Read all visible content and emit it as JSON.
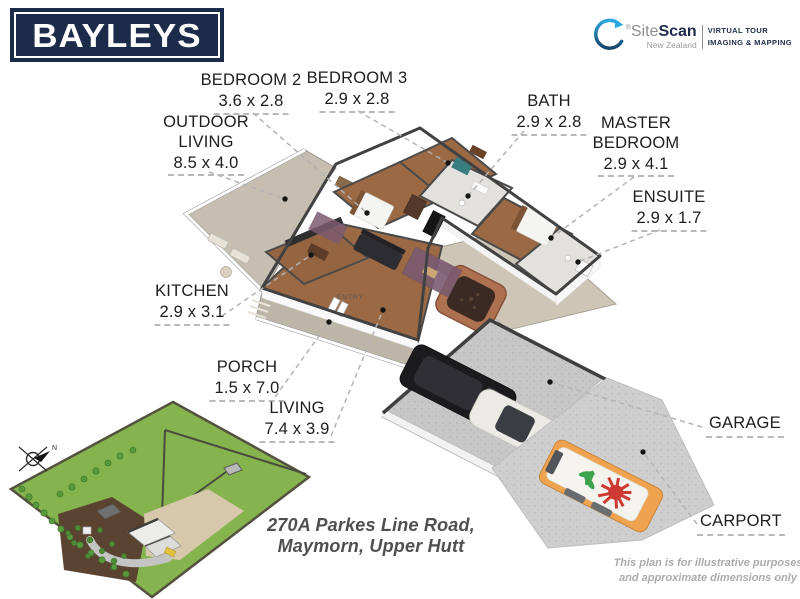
{
  "brand": {
    "logo_text": "BAYLEYS",
    "sitescan": {
      "registered_mark": "®",
      "site": "Site",
      "scan": "Scan",
      "region": "New Zealand",
      "tag_line1": "VIRTUAL TOUR",
      "tag_line2": "IMAGING & MAPPING"
    }
  },
  "address": {
    "line1": "270A Parkes Line Road,",
    "line2": "Maymorn, Upper Hutt"
  },
  "disclaimer": {
    "line1": "This plan is for illustrative purposes",
    "line2": "and approximate dimensions only"
  },
  "plan": {
    "entry_label": "ENTRY",
    "compass_label": "N"
  },
  "rooms": [
    {
      "id": "bedroom2",
      "name": "BEDROOM 2",
      "dims": "3.6 x 2.8"
    },
    {
      "id": "bedroom3",
      "name": "BEDROOM 3",
      "dims": "2.9 x 2.8"
    },
    {
      "id": "outdoor-living",
      "name": "OUTDOOR LIVING",
      "dims": "8.5 x 4.0"
    },
    {
      "id": "bath",
      "name": "BATH",
      "dims": "2.9 x 2.8"
    },
    {
      "id": "master-bedroom",
      "name": "MASTER BEDROOM",
      "dims": "2.9 x 4.1"
    },
    {
      "id": "ensuite",
      "name": "ENSUITE",
      "dims": "2.9 x 1.7"
    },
    {
      "id": "kitchen",
      "name": "KITCHEN",
      "dims": "2.9 x 3.1"
    },
    {
      "id": "porch",
      "name": "PORCH",
      "dims": "1.5 x 7.0"
    },
    {
      "id": "living",
      "name": "LIVING",
      "dims": "7.4 x 3.9"
    },
    {
      "id": "garage",
      "name": "GARAGE",
      "dims": ""
    },
    {
      "id": "carport",
      "name": "CARPORT",
      "dims": ""
    }
  ],
  "colors": {
    "brand_navy": "#1c2b4a",
    "swoosh_blue": "#2aa7de",
    "grass_green": "#85b44e",
    "floor_wood": "#9b6a44",
    "deck_grey": "#c6bfb1",
    "concrete": "#c9c9c9",
    "leader_grey": "#b3b3b3"
  }
}
